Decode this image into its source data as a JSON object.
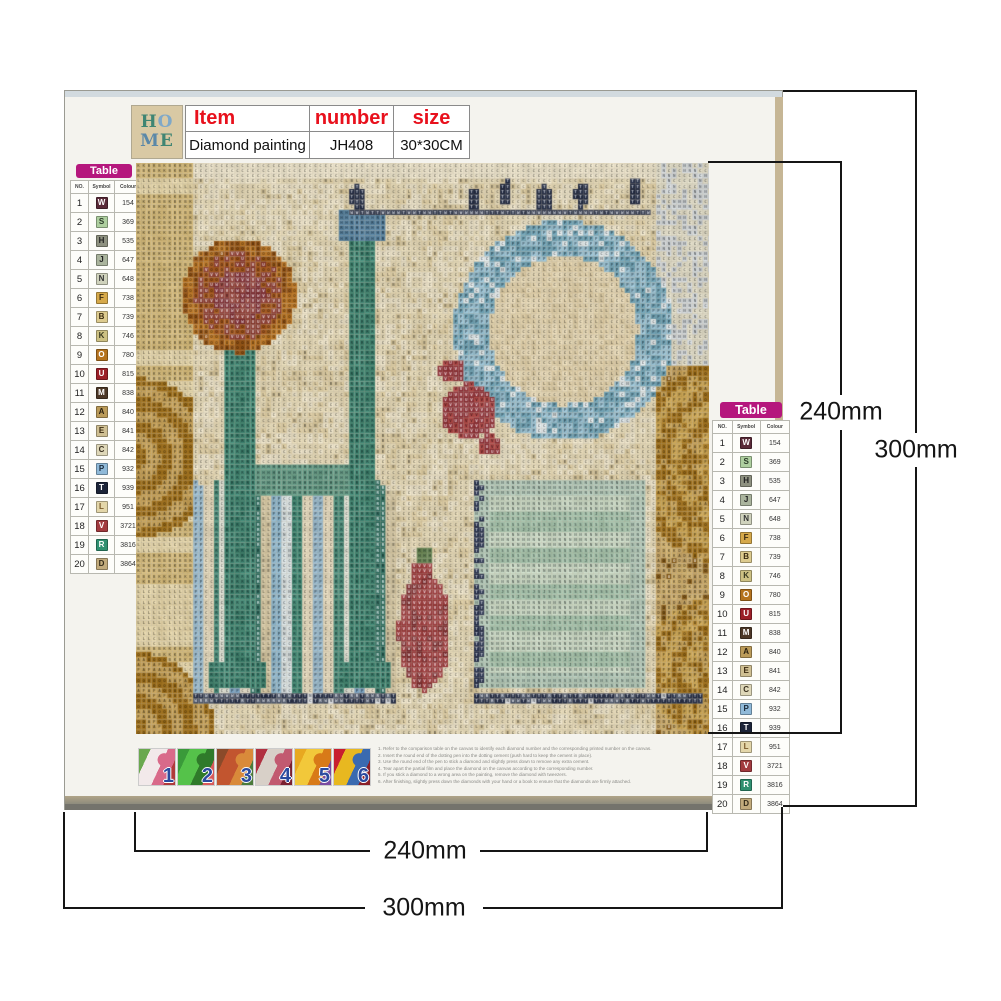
{
  "product": {
    "item_label": "Item",
    "number_label": "number",
    "size_label": "size",
    "item_value": "Diamond painting",
    "number_value": "JH408",
    "size_value": "30*30CM",
    "accent_red": "#e8101c"
  },
  "logo": {
    "bg": "#d9c9a4",
    "rows": [
      [
        {
          "ch": "H",
          "color": "#3f8573"
        },
        {
          "ch": "O",
          "color": "#7fa8c8"
        }
      ],
      [
        {
          "ch": "M",
          "color": "#5b88a8"
        },
        {
          "ch": "E",
          "color": "#3f8573"
        }
      ]
    ]
  },
  "palette": {
    "title": "Table",
    "title_bg": "#b5177d",
    "columns": [
      "NO.",
      "Symbol",
      "Colour"
    ],
    "rows": [
      {
        "no": 1,
        "symbol": "W",
        "code": "154",
        "bg": "#5a2a38",
        "fg": "#ffffff"
      },
      {
        "no": 2,
        "symbol": "S",
        "code": "369",
        "bg": "#aecf9f",
        "fg": "#2a3a28"
      },
      {
        "no": 3,
        "symbol": "H",
        "code": "535",
        "bg": "#8e9180",
        "fg": "#222222"
      },
      {
        "no": 4,
        "symbol": "J",
        "code": "647",
        "bg": "#aab49d",
        "fg": "#222222"
      },
      {
        "no": 5,
        "symbol": "N",
        "code": "648",
        "bg": "#cfd2bc",
        "fg": "#333333"
      },
      {
        "no": 6,
        "symbol": "F",
        "code": "738",
        "bg": "#d6a94a",
        "fg": "#3a2a10"
      },
      {
        "no": 7,
        "symbol": "B",
        "code": "739",
        "bg": "#ddcb8e",
        "fg": "#3a2a10"
      },
      {
        "no": 8,
        "symbol": "K",
        "code": "746",
        "bg": "#cdc183",
        "fg": "#3a3a20"
      },
      {
        "no": 9,
        "symbol": "O",
        "code": "780",
        "bg": "#b5731d",
        "fg": "#ffffff"
      },
      {
        "no": 10,
        "symbol": "U",
        "code": "815",
        "bg": "#9c1f27",
        "fg": "#ffffff"
      },
      {
        "no": 11,
        "symbol": "M",
        "code": "838",
        "bg": "#4d3827",
        "fg": "#ffffff"
      },
      {
        "no": 12,
        "symbol": "A",
        "code": "840",
        "bg": "#bb9b59",
        "fg": "#2a2010"
      },
      {
        "no": 13,
        "symbol": "E",
        "code": "841",
        "bg": "#cfbf92",
        "fg": "#3a2a10"
      },
      {
        "no": 14,
        "symbol": "C",
        "code": "842",
        "bg": "#ded7b8",
        "fg": "#3a3020"
      },
      {
        "no": 15,
        "symbol": "P",
        "code": "932",
        "bg": "#8fb9d8",
        "fg": "#1a2a3a"
      },
      {
        "no": 16,
        "symbol": "T",
        "code": "939",
        "bg": "#1c2438",
        "fg": "#ffffff"
      },
      {
        "no": 17,
        "symbol": "L",
        "code": "951",
        "bg": "#e3d6a9",
        "fg": "#7a5a2a"
      },
      {
        "no": 18,
        "symbol": "V",
        "code": "3721",
        "bg": "#a23a3e",
        "fg": "#ffffff"
      },
      {
        "no": 19,
        "symbol": "R",
        "code": "3816",
        "bg": "#2f9070",
        "fg": "#ffffff"
      },
      {
        "no": 20,
        "symbol": "D",
        "code": "3864",
        "bg": "#c2ab7c",
        "fg": "#332a18"
      }
    ]
  },
  "artwork": {
    "depicts": "Vintage HOME letter-collage diamond painting chart with symbol grid, birds on a wire, blue wreath O, red ornament and gold lace",
    "base": "#e8dcba",
    "cream": "#efe6cc",
    "teal": "#47907d",
    "teal_light": "#68a18d",
    "blue_ring": "#9cc5d8",
    "blue_ring_dark": "#74a8bc",
    "navy": "#232c44",
    "gold": "#b5872f",
    "gold_light": "#d4b470",
    "gold_dark": "#8a5f1c",
    "wall_gold": "#d9bf7f",
    "red_dark": "#8e3038",
    "red": "#b04848",
    "vase": "#9a393c",
    "vase_dark": "#7c2c30",
    "mint": "#cfe0cd",
    "mint_dark": "#a9c8b2",
    "sage": "#b7cfc0",
    "stripes": [
      "#9dbfd4",
      "#e7dcc0",
      "#4f9382",
      "#e3e6da",
      "#7fa8c8",
      "#efe7d4",
      "#2f6f62",
      "#d8cba8",
      "#8fb8cf",
      "#dfe8ea",
      "#47907d",
      "#e7dcc0"
    ]
  },
  "steps": {
    "number_color": "#2a4a9e",
    "thumbnails": [
      {
        "label": "1",
        "colors": [
          "#6aa84f",
          "#f2e9ea",
          "#d96a8a",
          "#b03a3a"
        ]
      },
      {
        "label": "2",
        "colors": [
          "#3a9a3a",
          "#55c24a",
          "#2f7a2a",
          "#d85a5a"
        ]
      },
      {
        "label": "3",
        "colors": [
          "#8a4a2a",
          "#c2552f",
          "#d98a3a",
          "#4a7a3a"
        ]
      },
      {
        "label": "4",
        "colors": [
          "#b03040",
          "#d8d0c8",
          "#c25a70",
          "#7a2030"
        ]
      },
      {
        "label": "5",
        "colors": [
          "#e8a820",
          "#f2c83a",
          "#d87a18",
          "#7a4aa0"
        ]
      },
      {
        "label": "6",
        "colors": [
          "#c81f2f",
          "#e8b820",
          "#3a6ab0",
          "#8a1f28"
        ]
      }
    ],
    "instructions": [
      "1. Refer to the comparison table on the canvas to identify each diamond number and the corresponding printed number on the canvas.",
      "2. Insert the round end of the dotting pen into the dotting cement (push hard to keep the cement in place).",
      "3. Use the round end of the pen to stick a diamond and slightly press down to remove any extra cement.",
      "4. Tear apart the partial film and place the diamond on the canvas according to the corresponding number.",
      "5. If you stick a diamond to a wrong area on the painting, remove the diamond with tweezers.",
      "6. After finishing, slightly press down the diamonds with your hand or a book to ensure that the diamonds are firmly attached."
    ]
  },
  "dimensions": {
    "inner": "240mm",
    "outer": "300mm"
  }
}
